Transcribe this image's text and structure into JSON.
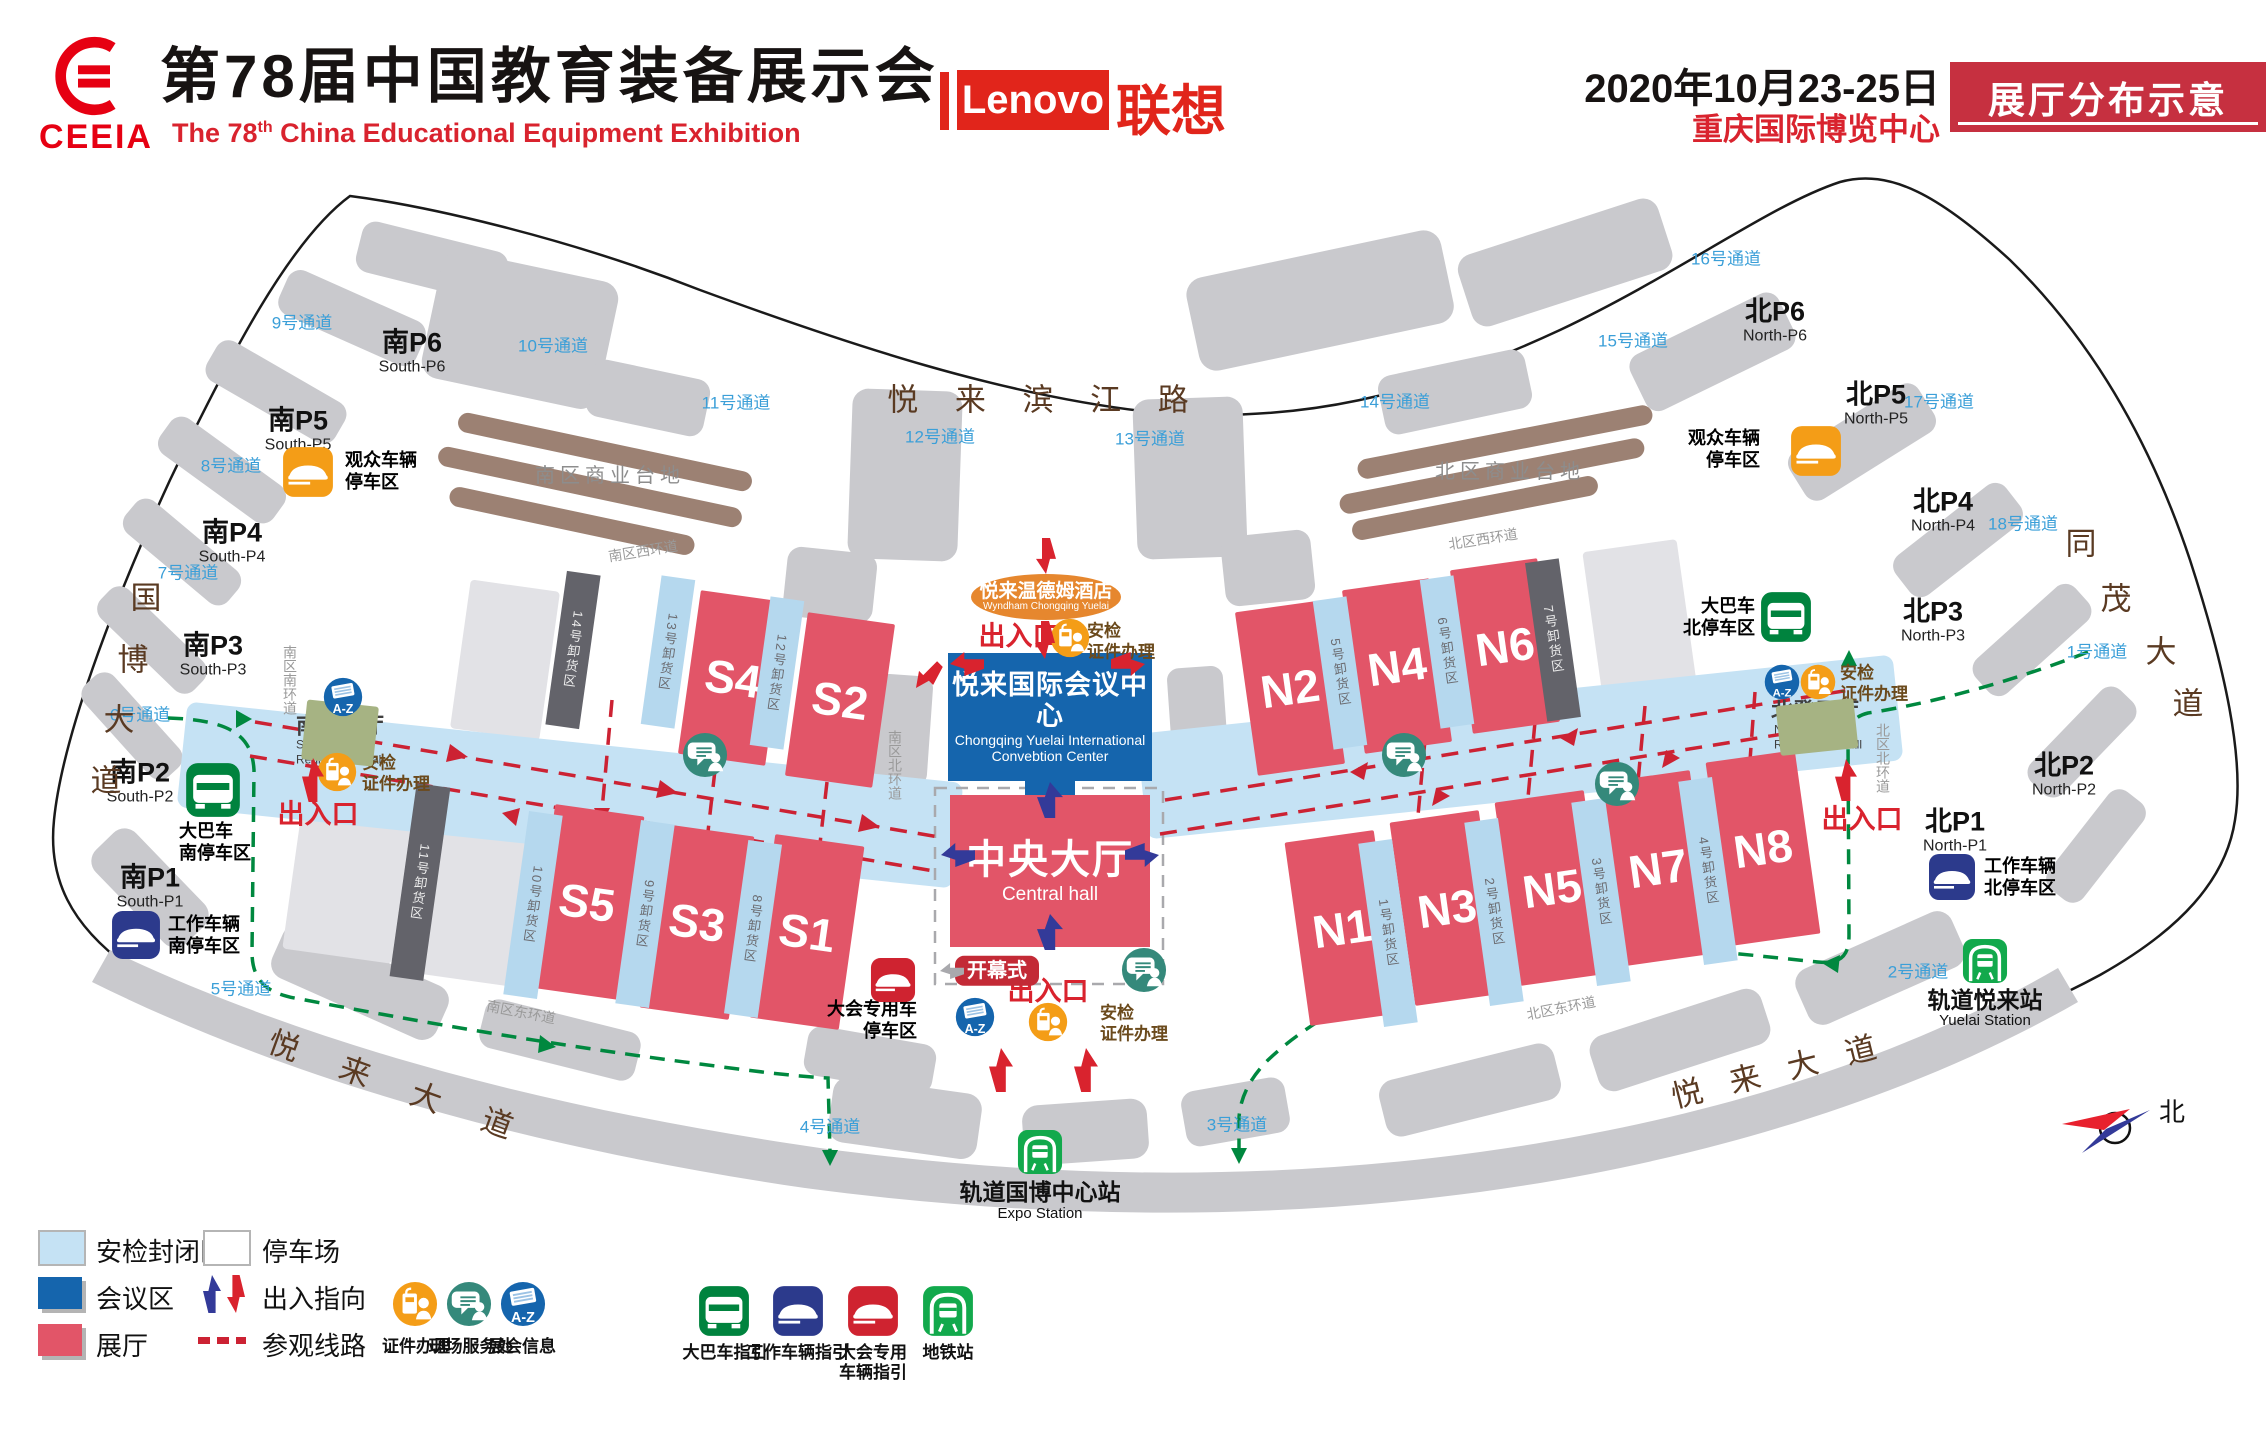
{
  "header": {
    "org": "CEEIA",
    "title_cn": "第78届中国教育装备展示会",
    "title_en_pre": "The 78",
    "title_en_sup": "th",
    "title_en_rest": " China  Educational  Equipment  Exhibition",
    "sponsor": "Lenovo",
    "sponsor_cn": "联想",
    "date": "2020年10月23-25日",
    "venue": "重庆国际博览中心",
    "badge": "展厅分布示意",
    "accent_red": "#e60012",
    "lenovo_red": "#e1251b",
    "badge_red": "#c63040"
  },
  "map": {
    "colors": {
      "hall": "#e25568",
      "secure_zone": "#c5e2f4",
      "conference": "#1565ad",
      "loading_light": "#b5d8ee",
      "loading_dark": "#63636a",
      "route_green": "#00883f",
      "route_red": "#cc2233",
      "passage_blue": "#3b9fd8",
      "road_brown": "#5a3a22",
      "hotel_orange": "#e6872e"
    },
    "central": {
      "title": "中央大厅",
      "subtitle": "Central hall"
    },
    "convention": {
      "title": "悦来国际会议中心",
      "sub1": "Chongqing Yuelai International",
      "sub2": "Convebtion Center"
    },
    "hotel": {
      "title": "悦来温德姆酒店",
      "subtitle": "Wyndham Chongqing Yuelai"
    },
    "halls": [
      {
        "label": "S4",
        "x": 733,
        "y": 678,
        "w": 88,
        "h": 165,
        "r": 8
      },
      {
        "label": "S2",
        "x": 840,
        "y": 700,
        "w": 88,
        "h": 165,
        "r": 8
      },
      {
        "label": "S5",
        "x": 587,
        "y": 902,
        "w": 90,
        "h": 185,
        "r": 8
      },
      {
        "label": "S3",
        "x": 697,
        "y": 922,
        "w": 90,
        "h": 185,
        "r": 8
      },
      {
        "label": "S1",
        "x": 807,
        "y": 932,
        "w": 90,
        "h": 185,
        "r": 8
      },
      {
        "label": "N2",
        "x": 1290,
        "y": 688,
        "w": 88,
        "h": 165,
        "r": -8
      },
      {
        "label": "N4",
        "x": 1397,
        "y": 666,
        "w": 88,
        "h": 165,
        "r": -8
      },
      {
        "label": "N6",
        "x": 1505,
        "y": 646,
        "w": 88,
        "h": 165,
        "r": -8
      },
      {
        "label": "N1",
        "x": 1342,
        "y": 928,
        "w": 90,
        "h": 185,
        "r": -8
      },
      {
        "label": "N3",
        "x": 1447,
        "y": 908,
        "w": 90,
        "h": 185,
        "r": -8
      },
      {
        "label": "N5",
        "x": 1552,
        "y": 888,
        "w": 90,
        "h": 185,
        "r": -8
      },
      {
        "label": "N7",
        "x": 1658,
        "y": 868,
        "w": 90,
        "h": 185,
        "r": -8
      },
      {
        "label": "N8",
        "x": 1763,
        "y": 848,
        "w": 90,
        "h": 185,
        "r": -8
      }
    ],
    "loading": [
      {
        "t": "14号卸货区",
        "x": 573,
        "y": 650,
        "h": 155,
        "r": 8,
        "dark": true
      },
      {
        "t": "13号卸货区",
        "x": 668,
        "y": 652,
        "h": 150,
        "r": 8
      },
      {
        "t": "12号卸货区",
        "x": 777,
        "y": 673,
        "h": 150,
        "r": 8
      },
      {
        "t": "11号卸货区",
        "x": 420,
        "y": 882,
        "h": 195,
        "r": 8,
        "dark": true
      },
      {
        "t": "10号卸货区",
        "x": 533,
        "y": 905,
        "h": 185,
        "r": 8
      },
      {
        "t": "9号卸货区",
        "x": 645,
        "y": 914,
        "h": 185,
        "r": 8
      },
      {
        "t": "8号卸货区",
        "x": 753,
        "y": 929,
        "h": 175,
        "r": 8
      },
      {
        "t": "5号卸货区",
        "x": 1340,
        "y": 673,
        "h": 150,
        "r": -8
      },
      {
        "t": "6号卸货区",
        "x": 1447,
        "y": 652,
        "h": 150,
        "r": -8
      },
      {
        "t": "7号卸货区",
        "x": 1553,
        "y": 640,
        "h": 160,
        "r": -8,
        "dark": true
      },
      {
        "t": "1号卸货区",
        "x": 1388,
        "y": 933,
        "h": 185,
        "r": -8
      },
      {
        "t": "2号卸货区",
        "x": 1494,
        "y": 912,
        "h": 185,
        "r": -8
      },
      {
        "t": "3号卸货区",
        "x": 1601,
        "y": 892,
        "h": 185,
        "r": -8
      },
      {
        "t": "4号卸货区",
        "x": 1708,
        "y": 871,
        "h": 185,
        "r": -8
      }
    ],
    "passages": [
      {
        "label": "1号通道",
        "x": 2097,
        "y": 650
      },
      {
        "label": "2号通道",
        "x": 1918,
        "y": 970
      },
      {
        "label": "3号通道",
        "x": 1237,
        "y": 1123
      },
      {
        "label": "4号通道",
        "x": 830,
        "y": 1125
      },
      {
        "label": "5号通道",
        "x": 241,
        "y": 987
      },
      {
        "label": "6号通道",
        "x": 140,
        "y": 713
      },
      {
        "label": "7号通道",
        "x": 188,
        "y": 571
      },
      {
        "label": "8号通道",
        "x": 231,
        "y": 464
      },
      {
        "label": "9号通道",
        "x": 302,
        "y": 321
      },
      {
        "label": "10号通道",
        "x": 553,
        "y": 344
      },
      {
        "label": "11号通道",
        "x": 736,
        "y": 401
      },
      {
        "label": "12号通道",
        "x": 940,
        "y": 435
      },
      {
        "label": "13号通道",
        "x": 1150,
        "y": 437
      },
      {
        "label": "14号通道",
        "x": 1395,
        "y": 400
      },
      {
        "label": "15号通道",
        "x": 1633,
        "y": 339
      },
      {
        "label": "16号通道",
        "x": 1726,
        "y": 257
      },
      {
        "label": "17号通道",
        "x": 1939,
        "y": 400
      },
      {
        "label": "18号通道",
        "x": 2023,
        "y": 522
      }
    ],
    "parkings": [
      {
        "cn": "南P6",
        "en": "South-P6",
        "x": 412,
        "y": 352
      },
      {
        "cn": "南P5",
        "en": "South-P5",
        "x": 298,
        "y": 430
      },
      {
        "cn": "南P4",
        "en": "South-P4",
        "x": 232,
        "y": 542
      },
      {
        "cn": "南P3",
        "en": "South-P3",
        "x": 213,
        "y": 655
      },
      {
        "cn": "南P2",
        "en": "South-P2",
        "x": 140,
        "y": 782
      },
      {
        "cn": "南P1",
        "en": "South-P1",
        "x": 150,
        "y": 887
      },
      {
        "cn": "北P6",
        "en": "North-P6",
        "x": 1775,
        "y": 321
      },
      {
        "cn": "北P5",
        "en": "North-P5",
        "x": 1876,
        "y": 404
      },
      {
        "cn": "北P4",
        "en": "North-P4",
        "x": 1943,
        "y": 511
      },
      {
        "cn": "北P3",
        "en": "North-P3",
        "x": 1933,
        "y": 621
      },
      {
        "cn": "北P2",
        "en": "North-P2",
        "x": 2064,
        "y": 775
      },
      {
        "cn": "北P1",
        "en": "North-P1",
        "x": 1955,
        "y": 831
      }
    ],
    "roads": [
      {
        "t": "悦 来 滨 江 路",
        "x": 1045,
        "y": 397,
        "cls": "major",
        "ls": 14
      },
      {
        "t": "悦 来 大 道",
        "x": 400,
        "y": 1085,
        "cls": "major",
        "rot": 20,
        "ls": 18
      },
      {
        "t": "悦 来 大 道",
        "x": 1778,
        "y": 1068,
        "cls": "major",
        "rot": -14,
        "ls": 10
      },
      {
        "t": "国",
        "x": 146,
        "y": 595,
        "cls": "major"
      },
      {
        "t": "博",
        "x": 133,
        "y": 657,
        "cls": "major"
      },
      {
        "t": "大",
        "x": 119,
        "y": 717,
        "cls": "major"
      },
      {
        "t": "道",
        "x": 106,
        "y": 778,
        "cls": "major"
      },
      {
        "t": "同",
        "x": 2081,
        "y": 541,
        "cls": "major"
      },
      {
        "t": "茂",
        "x": 2116,
        "y": 596,
        "cls": "major"
      },
      {
        "t": "大",
        "x": 2161,
        "y": 649,
        "cls": "major"
      },
      {
        "t": "道",
        "x": 2188,
        "y": 701,
        "cls": "major"
      },
      {
        "t": "南区西环道",
        "x": 643,
        "y": 551,
        "cls": "minor",
        "rot": -9
      },
      {
        "t": "北区西环道",
        "x": 1483,
        "y": 539,
        "cls": "minor",
        "rot": -9
      },
      {
        "t": "南区南环道",
        "x": 290,
        "y": 680,
        "cls": "minor",
        "v": true
      },
      {
        "t": "南区北环道",
        "x": 895,
        "y": 765,
        "cls": "minor",
        "v": true
      },
      {
        "t": "北区北环道",
        "x": 1883,
        "y": 758,
        "cls": "minor",
        "v": true
      },
      {
        "t": "南区东环道",
        "x": 521,
        "y": 1012,
        "cls": "minor",
        "rot": 11
      },
      {
        "t": "北区东环道",
        "x": 1561,
        "y": 1008,
        "cls": "minor",
        "rot": -11
      }
    ],
    "labels": [
      {
        "cls": "lbl-veh",
        "lines": [
          "观众车辆",
          "停车区"
        ],
        "x": 345,
        "y": 472,
        "anchor": "l",
        "name": "visitor-parking-label-south"
      },
      {
        "cls": "lbl-veh",
        "lines": [
          "观众车辆",
          "停车区"
        ],
        "x": 1760,
        "y": 450,
        "anchor": "r",
        "name": "visitor-parking-label-north"
      },
      {
        "cls": "lbl-veh",
        "lines": [
          "大巴车",
          "南停车区"
        ],
        "x": 215,
        "y": 843,
        "anchor": "c",
        "name": "bus-parking-south-label"
      },
      {
        "cls": "lbl-veh",
        "lines": [
          "大巴车",
          "北停车区"
        ],
        "x": 1755,
        "y": 618,
        "anchor": "r",
        "name": "bus-parking-north-label"
      },
      {
        "cls": "lbl-veh",
        "lines": [
          "工作车辆",
          "南停车区"
        ],
        "x": 168,
        "y": 936,
        "anchor": "l",
        "name": "staff-parking-south-label"
      },
      {
        "cls": "lbl-veh",
        "lines": [
          "工作车辆",
          "北停车区"
        ],
        "x": 1984,
        "y": 878,
        "anchor": "l",
        "name": "staff-parking-north-label"
      },
      {
        "cls": "lbl-veh",
        "lines": [
          "大会专用车",
          "停车区"
        ],
        "x": 917,
        "y": 1021,
        "anchor": "r",
        "name": "conference-car-parking-label"
      },
      {
        "cls": "lbl-station-cn",
        "lines": [
          "轨道国博中心站"
        ],
        "x": 1040,
        "y": 1192,
        "anchor": "c",
        "name": "expo-station-name-cn"
      },
      {
        "cls": "lbl-station-en",
        "lines": [
          "Expo Station"
        ],
        "x": 1040,
        "y": 1214,
        "anchor": "c",
        "name": "expo-station-name-en"
      },
      {
        "cls": "lbl-station-cn",
        "lines": [
          "轨道悦来站"
        ],
        "x": 1985,
        "y": 1000,
        "anchor": "c",
        "name": "yuelai-station-name-cn"
      },
      {
        "cls": "lbl-station-en",
        "lines": [
          "Yuelai Station"
        ],
        "x": 1985,
        "y": 1021,
        "anchor": "c",
        "name": "yuelai-station-name-en"
      },
      {
        "cls": "lbl-reg-cn",
        "lines": [
          "南登录厅"
        ],
        "x": 340,
        "y": 727,
        "anchor": "c",
        "name": "south-registration-hall-cn"
      },
      {
        "cls": "lbl-reg-en",
        "lines": [
          "Southern",
          "Registration Hall"
        ],
        "x": 340,
        "y": 752,
        "anchor": "c",
        "name": "south-registration-hall-en"
      },
      {
        "cls": "lbl-reg-cn",
        "lines": [
          "北登录厅"
        ],
        "x": 1815,
        "y": 712,
        "anchor": "c",
        "name": "north-registration-hall-cn"
      },
      {
        "cls": "lbl-reg-en",
        "lines": [
          "Noethern",
          "Registration Hall"
        ],
        "x": 1818,
        "y": 737,
        "anchor": "c",
        "name": "north-registration-hall-en"
      },
      {
        "cls": "lbl-entrance",
        "lines": [
          "出入口"
        ],
        "x": 318,
        "y": 815,
        "anchor": "c",
        "name": "entrance-label-south"
      },
      {
        "cls": "lbl-entrance",
        "lines": [
          "出入口"
        ],
        "x": 1019,
        "y": 637,
        "anchor": "c",
        "name": "entrance-label-top"
      },
      {
        "cls": "lbl-entrance",
        "lines": [
          "出入口"
        ],
        "x": 1048,
        "y": 992,
        "anchor": "c",
        "name": "entrance-label-bottom"
      },
      {
        "cls": "lbl-entrance",
        "lines": [
          "出入口"
        ],
        "x": 1862,
        "y": 820,
        "anchor": "c",
        "name": "entrance-label-north"
      },
      {
        "cls": "lbl-cred",
        "lines": [
          "安检",
          "证件办理"
        ],
        "x": 362,
        "y": 774,
        "anchor": "l",
        "name": "security-credential-label-south"
      },
      {
        "cls": "lbl-cred",
        "lines": [
          "安检",
          "证件办理"
        ],
        "x": 1087,
        "y": 642,
        "anchor": "l",
        "name": "security-credential-label-top"
      },
      {
        "cls": "lbl-cred",
        "lines": [
          "安检",
          "证件办理"
        ],
        "x": 1100,
        "y": 1024,
        "anchor": "l",
        "name": "security-credential-label-bottom"
      },
      {
        "cls": "lbl-cred",
        "lines": [
          "安检",
          "证件办理"
        ],
        "x": 1840,
        "y": 684,
        "anchor": "l",
        "name": "security-credential-label-north"
      },
      {
        "cls": "lbl-commercial",
        "lines": [
          "南区商业台地"
        ],
        "x": 610,
        "y": 476,
        "anchor": "c",
        "name": "south-commercial-terrace-label"
      },
      {
        "cls": "lbl-commercial",
        "lines": [
          "北区商业台地"
        ],
        "x": 1510,
        "y": 472,
        "anchor": "c",
        "name": "north-commercial-terrace-label"
      },
      {
        "cls": "lbl-opening",
        "lines": [
          "开幕式"
        ],
        "x": 997,
        "y": 971,
        "anchor": "c",
        "name": "opening-ceremony-badge"
      },
      {
        "cls": "lbl-compass",
        "lines": [
          "北"
        ],
        "x": 2172,
        "y": 1113,
        "anchor": "c",
        "name": "compass-north-label"
      }
    ],
    "icons": [
      {
        "type": "car-orange",
        "x": 308,
        "y": 472,
        "s": 52
      },
      {
        "type": "car-orange",
        "x": 1816,
        "y": 451,
        "s": 52
      },
      {
        "type": "bus-green",
        "x": 213,
        "y": 790,
        "s": 56
      },
      {
        "type": "bus-green",
        "x": 1786,
        "y": 617,
        "s": 52
      },
      {
        "type": "car-blue",
        "x": 136,
        "y": 935,
        "s": 50
      },
      {
        "type": "car-blue",
        "x": 1952,
        "y": 877,
        "s": 48
      },
      {
        "type": "car-red",
        "x": 893,
        "y": 980,
        "s": 46
      },
      {
        "type": "metro",
        "x": 1040,
        "y": 1152,
        "s": 46
      },
      {
        "type": "metro",
        "x": 1985,
        "y": 961,
        "s": 46
      },
      {
        "type": "az",
        "x": 343,
        "y": 697,
        "s": 40
      },
      {
        "type": "az",
        "x": 975,
        "y": 1017,
        "s": 40
      },
      {
        "type": "az",
        "x": 1782,
        "y": 682,
        "s": 36
      },
      {
        "type": "cred",
        "x": 337,
        "y": 772,
        "s": 40
      },
      {
        "type": "cred",
        "x": 1070,
        "y": 638,
        "s": 40
      },
      {
        "type": "cred",
        "x": 1048,
        "y": 1022,
        "s": 40
      },
      {
        "type": "cred",
        "x": 1818,
        "y": 682,
        "s": 36
      },
      {
        "type": "service",
        "x": 705,
        "y": 755,
        "s": 46
      },
      {
        "type": "service",
        "x": 1144,
        "y": 970,
        "s": 46
      },
      {
        "type": "service",
        "x": 1404,
        "y": 755,
        "s": 46
      },
      {
        "type": "service",
        "x": 1617,
        "y": 784,
        "s": 46
      }
    ],
    "arrows": [
      {
        "dir": "up",
        "x": 313,
        "y": 780,
        "w": 22,
        "h": 44,
        "c": "red"
      },
      {
        "dir": "down",
        "x": 1046,
        "y": 556,
        "w": 20,
        "h": 36,
        "c": "red"
      },
      {
        "dir": "down",
        "x": 1045,
        "y": 640,
        "w": 20,
        "h": 38,
        "c": "red"
      },
      {
        "dir": "left",
        "x": 967,
        "y": 664,
        "w": 24,
        "h": 34,
        "c": "red"
      },
      {
        "dir": "right",
        "x": 1128,
        "y": 664,
        "w": 24,
        "h": 34,
        "c": "red"
      },
      {
        "dir": "sw",
        "x": 928,
        "y": 676,
        "w": 20,
        "h": 34,
        "c": "red"
      },
      {
        "dir": "up",
        "x": 1001,
        "y": 1070,
        "w": 24,
        "h": 44,
        "c": "red"
      },
      {
        "dir": "up",
        "x": 1086,
        "y": 1070,
        "w": 24,
        "h": 44,
        "c": "red"
      },
      {
        "dir": "up",
        "x": 1846,
        "y": 780,
        "w": 22,
        "h": 42,
        "c": "red"
      },
      {
        "dir": "up",
        "x": 1050,
        "y": 800,
        "w": 26,
        "h": 36,
        "c": "navy"
      },
      {
        "dir": "left",
        "x": 958,
        "y": 855,
        "w": 24,
        "h": 34,
        "c": "navy"
      },
      {
        "dir": "right",
        "x": 1142,
        "y": 855,
        "w": 24,
        "h": 34,
        "c": "navy"
      },
      {
        "dir": "up",
        "x": 1050,
        "y": 932,
        "w": 26,
        "h": 36,
        "c": "navy"
      },
      {
        "dir": "left",
        "x": 952,
        "y": 971,
        "w": 16,
        "h": 24,
        "c": "gray"
      }
    ],
    "patches": [
      {
        "x": 340,
        "y": 733,
        "w": 72,
        "h": 60,
        "r": 6
      },
      {
        "x": 1817,
        "y": 727,
        "w": 78,
        "h": 50,
        "r": -6
      }
    ]
  },
  "legend": {
    "rows": [
      {
        "label": "安检封闭区",
        "sw": "secure"
      },
      {
        "label": "停车场",
        "sw": "park"
      },
      {
        "label": "会议区",
        "sw": "conf"
      },
      {
        "label": "出入指向",
        "sw": "arrows"
      },
      {
        "label": "展厅",
        "sw": "hall"
      },
      {
        "label": "参观线路",
        "sw": "dash"
      }
    ],
    "icons": [
      {
        "type": "cred",
        "label": "证件办理"
      },
      {
        "type": "service",
        "label": "现场服务处"
      },
      {
        "type": "az",
        "label": "展会信息"
      },
      {
        "type": "bus-green",
        "label": "大巴车指引"
      },
      {
        "type": "car-blue",
        "label": "工作车辆指引"
      },
      {
        "type": "car-red",
        "label": "大会专用\n车辆指引"
      },
      {
        "type": "metro",
        "label": "地铁站"
      }
    ]
  }
}
